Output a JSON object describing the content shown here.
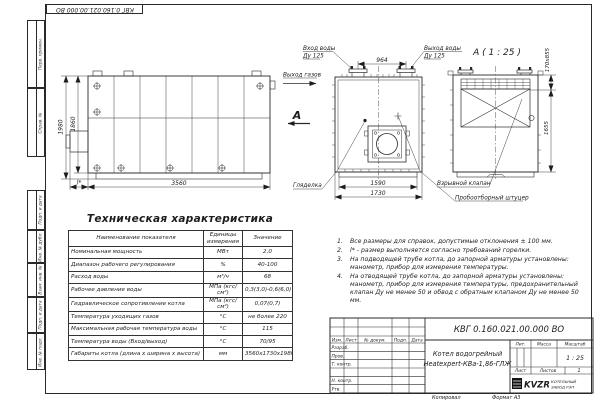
{
  "frame": {
    "doc_number_top": "КВГ 0.160.021.00.000 ВО",
    "side_labels": [
      "Перв. примен.",
      "Справ. №",
      "Подп. и дата",
      "Инв. № дубл.",
      "Взам. инв. №",
      "Подп. и дата",
      "Инв. № подл."
    ],
    "footer_copy": "Копировал",
    "footer_format": "Формат А3"
  },
  "views": {
    "side": {
      "dim_height_outer": "1980",
      "dim_height_inner": "1860",
      "dim_length": "3560",
      "dim_burner": "l*"
    },
    "front": {
      "label_water_in": "Вход воды",
      "label_water_in_dn": "Ду 125",
      "label_water_out": "Выход воды",
      "label_water_out_dn": "Ду 125",
      "dim_flanges": "964",
      "label_gas_out": "Выход газов",
      "view_letter": "А",
      "label_sight_glass": "Гляделка",
      "dim_base": "1590",
      "dim_width": "1730",
      "label_explosion_valve": "Взрывной клапан",
      "label_sampling_fitting": "Пробоотборный штуцер"
    },
    "rear": {
      "title": "А ( 1 : 25 )",
      "dim_flue": "170х855",
      "dim_height": "1655"
    }
  },
  "spec_table": {
    "title": "Техническая характеристика",
    "headers": [
      "Наименование показателя",
      "Единицы измерения",
      "Значение"
    ],
    "rows": [
      [
        "Номинальная мощность",
        "МВт",
        "2,0"
      ],
      [
        "Диапазон рабочего регулирования",
        "%",
        "40-100"
      ],
      [
        "Расход воды",
        "м³/ч",
        "68"
      ],
      [
        "Рабочее давление воды",
        "МПа (кгс/см²)",
        "0,3(3,0)-0,6(6,0)"
      ],
      [
        "Гидравлическое сопротивление котла",
        "МПа (кгс/см²)",
        "0,07(0,7)"
      ],
      [
        "Температура уходящих газов",
        "°С",
        "не более 220"
      ],
      [
        "Максимальная рабочая температура воды",
        "°С",
        "115"
      ],
      [
        "Температура воды (Вход/выход)",
        "°С",
        "70/95"
      ],
      [
        "Габариты котла (длина х ширина х высота)",
        "мм",
        "3560х1730х1980"
      ]
    ]
  },
  "notes": {
    "items": [
      {
        "num": "1.",
        "text": "Все размеры для справок, допустимые отклонения ± 100 мм."
      },
      {
        "num": "2.",
        "text": "l* - размер выполняется согласно требований горелки."
      },
      {
        "num": "3.",
        "text": "На подводящей трубе котла, до запорной арматуры установлены: манометр, прибор для измерения температуры."
      },
      {
        "num": "4.",
        "text": "На отводящей трубе котла, до запорной арматуры установлены: манометр, прибор для измерения температуры, предохранительный клапан Ду не менее 50 и обвод с обратным клапаном Ду не менее 50 мм."
      }
    ]
  },
  "stamp": {
    "doc_number": "КВГ 0.160.021.00.000 ВО",
    "product_line1": "Котел водогрейный",
    "product_line2": "Heatexpert-КВа-1,86-ГЛЖ",
    "col_izm": "Изм.",
    "col_list": "Лист",
    "col_docnum": "№ докум.",
    "col_podp": "Подп.",
    "col_data": "Дата",
    "row_razrab": "Разраб.",
    "row_prov": "Пров.",
    "row_tkontr": "Т. контр.",
    "row_nkontr": "Н. контр.",
    "row_utv": "Утв.",
    "lit_label": "Лит.",
    "mass_label": "Масса",
    "scale_label": "Масштаб",
    "scale_value": "1 : 25",
    "sheet_label": "Лист",
    "sheets_label": "Листов",
    "sheets_value": "1",
    "logo_abbr": "KVZR",
    "logo_name1": "КОТЕЛЬНЫЙ",
    "logo_name2": "ЗАВОД РЭП"
  }
}
